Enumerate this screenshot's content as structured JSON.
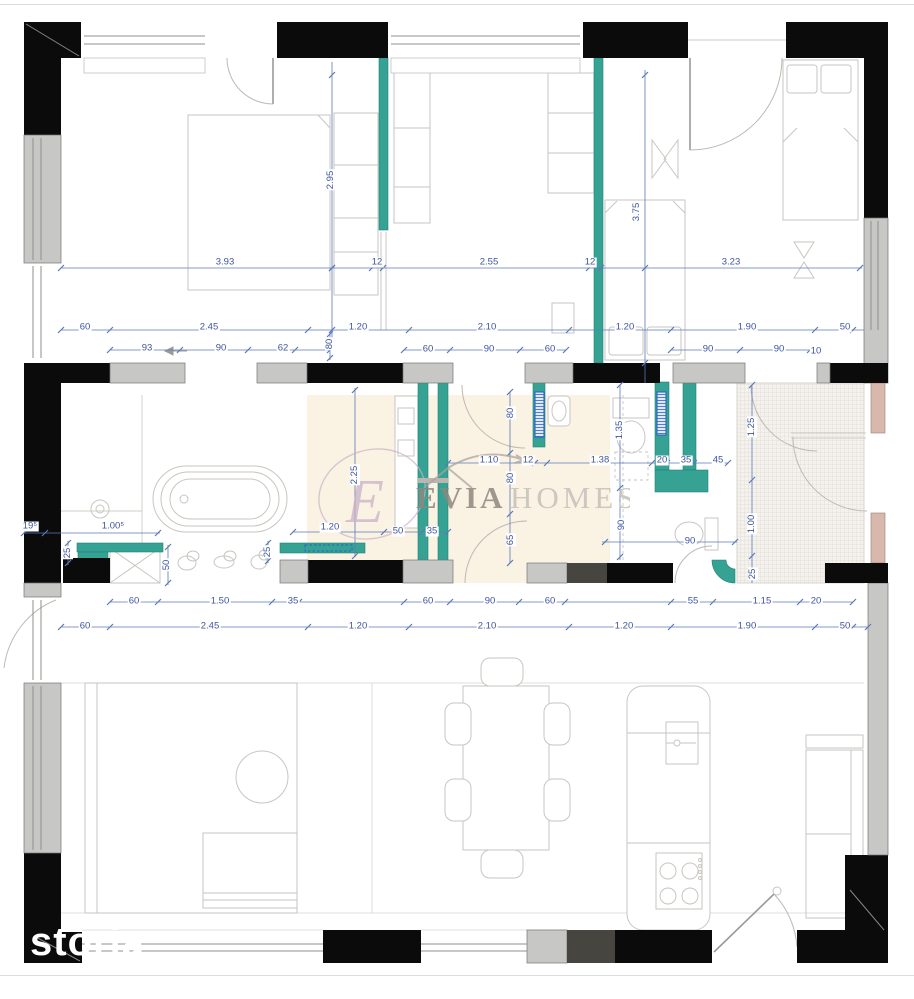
{
  "watermarks": {
    "brand_bold": "EVIA",
    "brand_light": "HOMES",
    "brand_initial": "E",
    "photo_credit": "storia"
  },
  "colors": {
    "wall_black": "#0b0b0b",
    "wall_gray": "#c7c7c5",
    "wall_dark": "#474540",
    "plumbing_teal": "#36a294",
    "dim_blue": "#3d55a0",
    "dim_line": "#5b79b8",
    "radiator_blue": "#2b62c9",
    "floor_beige": "#faf3e4",
    "terrace_hatch": "#dcd7d0",
    "door_reveal_pink": "#d8b7ad",
    "furniture_line": "#c9c6c0",
    "watermark_dark": "#8d8880",
    "watermark_light": "#c5c1ba",
    "watermark_accent": "#c9afc6",
    "photo_credit_white": "#ffffff"
  },
  "dimensions": [
    {
      "t": "3.93",
      "x": 225,
      "y": 263
    },
    {
      "t": "12",
      "x": 377,
      "y": 263
    },
    {
      "t": "2.55",
      "x": 489,
      "y": 263
    },
    {
      "t": "12",
      "x": 590,
      "y": 263
    },
    {
      "t": "3.23",
      "x": 731,
      "y": 263
    },
    {
      "t": "2.95",
      "x": 331,
      "y": 180,
      "v": 1
    },
    {
      "t": "3.75",
      "x": 637,
      "y": 212,
      "v": 1
    },
    {
      "t": "60",
      "x": 85,
      "y": 328
    },
    {
      "t": "2.45",
      "x": 209,
      "y": 328
    },
    {
      "t": "1.20",
      "x": 358,
      "y": 328
    },
    {
      "t": "2.10",
      "x": 487,
      "y": 328
    },
    {
      "t": "1.20",
      "x": 625,
      "y": 328
    },
    {
      "t": "1.90",
      "x": 747,
      "y": 328
    },
    {
      "t": "50",
      "x": 845,
      "y": 328
    },
    {
      "t": "93",
      "x": 147,
      "y": 349
    },
    {
      "t": "90",
      "x": 221,
      "y": 349
    },
    {
      "t": "62",
      "x": 283,
      "y": 349
    },
    {
      "t": "80",
      "x": 330,
      "y": 344,
      "v": 1
    },
    {
      "t": "60",
      "x": 428,
      "y": 350
    },
    {
      "t": "90",
      "x": 489,
      "y": 350
    },
    {
      "t": "60",
      "x": 550,
      "y": 350
    },
    {
      "t": "90",
      "x": 708,
      "y": 350
    },
    {
      "t": "90",
      "x": 779,
      "y": 350
    },
    {
      "t": "10",
      "x": 816,
      "y": 352
    },
    {
      "t": "2.25",
      "x": 355,
      "y": 475,
      "v": 1
    },
    {
      "t": "1.10",
      "x": 489,
      "y": 461
    },
    {
      "t": "12",
      "x": 528,
      "y": 461
    },
    {
      "t": "1.38",
      "x": 600,
      "y": 461
    },
    {
      "t": "20",
      "x": 662,
      "y": 461
    },
    {
      "t": "35",
      "x": 686,
      "y": 461
    },
    {
      "t": "45",
      "x": 718,
      "y": 461
    },
    {
      "t": "80",
      "x": 511,
      "y": 413,
      "v": 1
    },
    {
      "t": "80",
      "x": 511,
      "y": 478,
      "v": 1
    },
    {
      "t": "65",
      "x": 511,
      "y": 540,
      "v": 1
    },
    {
      "t": "1.35",
      "x": 620,
      "y": 430,
      "v": 1
    },
    {
      "t": "90",
      "x": 622,
      "y": 525,
      "v": 1
    },
    {
      "t": "90",
      "x": 690,
      "y": 542
    },
    {
      "t": "1.25",
      "x": 752,
      "y": 427,
      "v": 1
    },
    {
      "t": "1.00",
      "x": 752,
      "y": 524,
      "v": 1
    },
    {
      "t": "25",
      "x": 753,
      "y": 574,
      "v": 1
    },
    {
      "t": "19⁵",
      "x": 30,
      "y": 527
    },
    {
      "t": "1.00⁵",
      "x": 113,
      "y": 527
    },
    {
      "t": "25",
      "x": 68,
      "y": 553,
      "v": 1
    },
    {
      "t": "50",
      "x": 167,
      "y": 565,
      "v": 1
    },
    {
      "t": "25",
      "x": 268,
      "y": 552,
      "v": 1
    },
    {
      "t": "1.20",
      "x": 330,
      "y": 528
    },
    {
      "t": "50",
      "x": 398,
      "y": 532
    },
    {
      "t": "35",
      "x": 432,
      "y": 532
    },
    {
      "t": "60",
      "x": 134,
      "y": 602
    },
    {
      "t": "1.50",
      "x": 220,
      "y": 602
    },
    {
      "t": "35",
      "x": 293,
      "y": 602
    },
    {
      "t": "60",
      "x": 428,
      "y": 602
    },
    {
      "t": "90",
      "x": 490,
      "y": 602
    },
    {
      "t": "60",
      "x": 550,
      "y": 602
    },
    {
      "t": "55",
      "x": 693,
      "y": 602
    },
    {
      "t": "1.15",
      "x": 762,
      "y": 602
    },
    {
      "t": "20",
      "x": 816,
      "y": 602
    },
    {
      "t": "60",
      "x": 85,
      "y": 627
    },
    {
      "t": "2.45",
      "x": 210,
      "y": 627
    },
    {
      "t": "1.20",
      "x": 358,
      "y": 627
    },
    {
      "t": "2.10",
      "x": 487,
      "y": 627
    },
    {
      "t": "1.20",
      "x": 624,
      "y": 627
    },
    {
      "t": "1.90",
      "x": 747,
      "y": 627
    },
    {
      "t": "50",
      "x": 845,
      "y": 627
    }
  ]
}
